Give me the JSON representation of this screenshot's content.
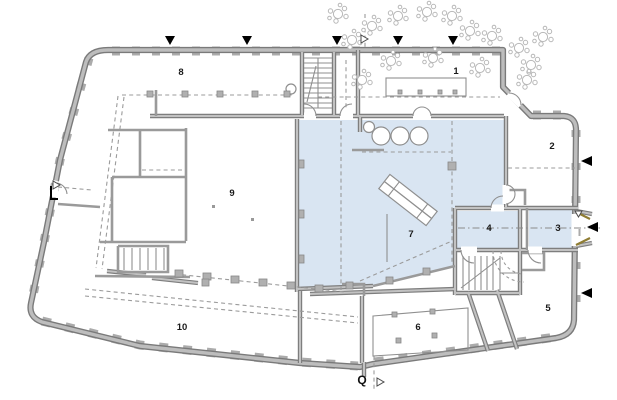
{
  "plan": {
    "rooms": [
      {
        "number": "1"
      },
      {
        "number": "2"
      },
      {
        "number": "3"
      },
      {
        "number": "4"
      },
      {
        "number": "5"
      },
      {
        "number": "6"
      },
      {
        "number": "7"
      },
      {
        "number": "8"
      },
      {
        "number": "9"
      },
      {
        "number": "10"
      }
    ],
    "section_label": "Q",
    "icons": {
      "view_direction_down": "▼",
      "view_direction_left": "◀",
      "section_pointer": "▷",
      "tree": "cluster-of-circles"
    },
    "colors": {
      "highlight": "#d9e5f2",
      "wall_fill": "#bdbdbd",
      "wall_edge": "#7a7a7a",
      "detail_line": "#8f8f8f",
      "tree_outline": "#b8b8b8",
      "door_accent": "#8f7d33",
      "marker_black": "#000000"
    }
  }
}
